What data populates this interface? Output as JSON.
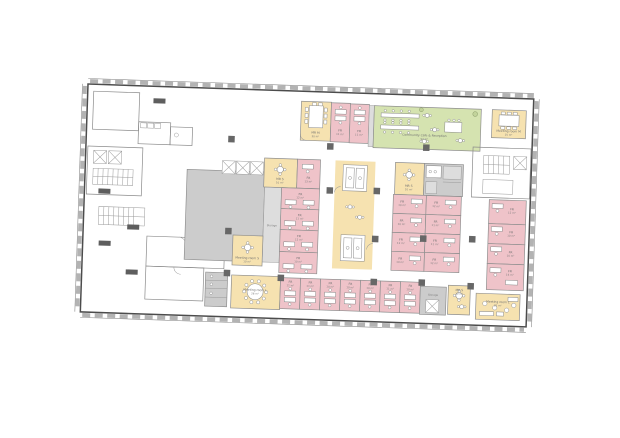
{
  "palette": {
    "office_pink": "#efc3c9",
    "meeting_yellow": "#f6e2b0",
    "cafe_green": "#d5e3b0",
    "core_grey": "#cccccc",
    "column_dark": "#676767",
    "wall_dark": "#4c4c4c"
  },
  "rooms": {
    "mr_m_top": {
      "label": "MR M",
      "area": "30 m²"
    },
    "fr_top": [
      {
        "label": "FR",
        "area": "11 m²"
      },
      {
        "label": "FR",
        "area": "11 m²"
      }
    ],
    "cafe": {
      "label": "Community Cafe & Reception",
      "area": "92 m²"
    },
    "meeting_room_m": {
      "label": "Meeting room M",
      "area": "15 m²"
    },
    "mr_s_upper_left": {
      "label": "MR S",
      "area": "10 m²"
    },
    "fr_upper_left": {
      "label": "FR",
      "area": "13 m²"
    },
    "fr_left_col": [
      {
        "label": "FR",
        "area": "12 m²"
      },
      {
        "label": "FR",
        "area": "11 m²"
      },
      {
        "label": "FR",
        "area": "12 m²"
      },
      {
        "label": "FR",
        "area": "10 m²"
      }
    ],
    "storage_left": {
      "label": "Storage"
    },
    "meeting_room_s": {
      "label": "Meeting room S",
      "area": "10 m²"
    },
    "mr_s_center": {
      "label": "MR S",
      "area": "10 m²"
    },
    "fr_center": [
      {
        "label": "FR",
        "area": "10 m²"
      },
      {
        "label": "FR",
        "area": "12 m²"
      },
      {
        "label": "FR",
        "area": "10 m²"
      },
      {
        "label": "FR",
        "area": "11 m²"
      },
      {
        "label": "FR",
        "area": "12 m²"
      },
      {
        "label": "FR",
        "area": "11 m²"
      },
      {
        "label": "FR",
        "area": "10 m²"
      },
      {
        "label": "FR",
        "area": "12 m²"
      }
    ],
    "fr_right_col": [
      {
        "label": "FR",
        "area": "12 m²"
      },
      {
        "label": "FR",
        "area": "10 m²"
      },
      {
        "label": "FR",
        "area": "10 m²"
      },
      {
        "label": "FR",
        "area": "14 m²"
      }
    ],
    "meeting_room_l_west": {
      "label": "Meeting room L",
      "area": "28 m²"
    },
    "fr_bottom_row": [
      {
        "label": "FR",
        "area": "11 m²"
      },
      {
        "label": "FR",
        "area": "11 m²"
      },
      {
        "label": "FR",
        "area": "10 m²"
      },
      {
        "label": "FR",
        "area": "10 m²"
      },
      {
        "label": "FR",
        "area": "10 m²"
      },
      {
        "label": "FR",
        "area": "11 m²"
      },
      {
        "label": "FR",
        "area": "10 m²"
      }
    ],
    "storage_bottom": {
      "label": "Storage"
    },
    "mr_s_bottom": {
      "label": "MR S",
      "area": "10 m²"
    },
    "meeting_room_l_east": {
      "label": "Meeting room L",
      "area": "25 m²"
    }
  }
}
